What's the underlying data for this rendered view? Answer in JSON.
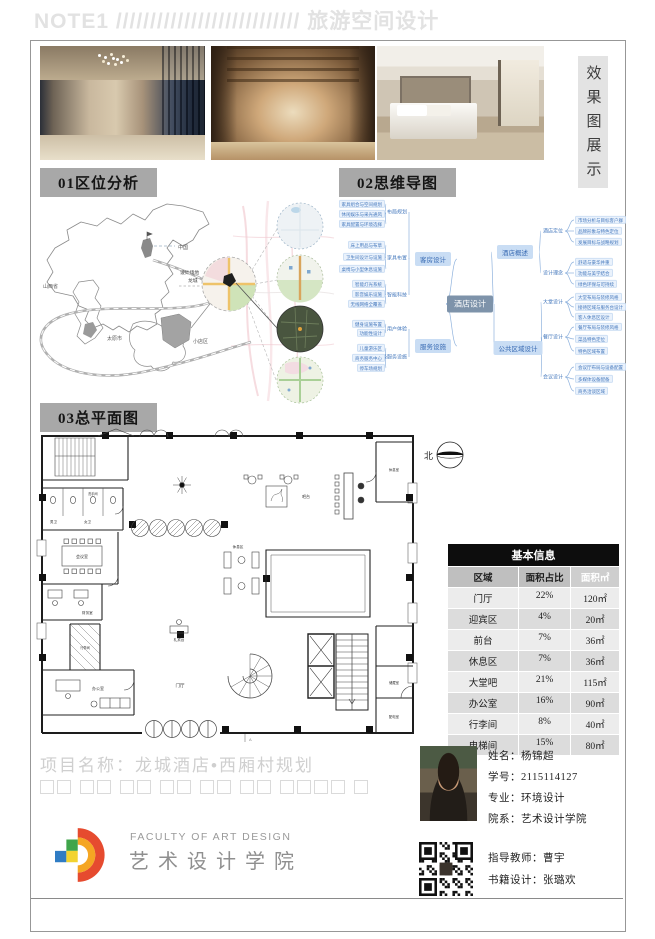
{
  "header": {
    "title": "NOTE1 /////////////////////////// 旅游空间设计"
  },
  "gallery": {
    "label": "效果图展示"
  },
  "sections": {
    "s1": "01区位分析",
    "s2": "02思维导图",
    "s3": "03总平面图"
  },
  "map": {
    "country": "中国",
    "province": "山西省",
    "city": "太原市",
    "district": "小店区",
    "site_line1": "设计场地",
    "site_line2": "龙城"
  },
  "mindmap": {
    "center": "酒店设计",
    "branches": [
      {
        "label": "客房设计",
        "children": [
          {
            "label": "布局规划",
            "leaves": [
              "家具组合与空间规划",
              "休闲娱乐与采光通风",
              "家具配置与环境选择"
            ]
          },
          {
            "label": "家具布置",
            "leaves": [
              "床上用品与布草",
              "卫生间设计与设施",
              "桌椅与小型休息设施"
            ]
          },
          {
            "label": "智能科技",
            "leaves": [
              "智能灯光系统",
              "影音娱乐设施",
              "无线网络全覆盖"
            ]
          }
        ]
      },
      {
        "label": "服务设施",
        "children": [
          {
            "label": "用户体验",
            "leaves": [
              "健身设施布置",
              "功能性设计"
            ]
          },
          {
            "label": "高级服务设施",
            "leaves": [
              "儿童游乐区",
              "商务服务中心",
              "停车场规划"
            ]
          }
        ]
      },
      {
        "label": "酒店概述",
        "children": [
          {
            "label": "酒店定位",
            "leaves": [
              "市场分析与目标客户群",
              "品牌形象与特色定位",
              "发展目标与战略规划"
            ]
          },
          {
            "label": "设计理念",
            "leaves": [
              "舒适与豪华并重",
              "功能与美学结合",
              "绿色环保与可持续"
            ]
          }
        ]
      },
      {
        "label": "公共区域设计",
        "children": [
          {
            "label": "大堂设计",
            "leaves": [
              "大堂布局与装修风格",
              "接待区域与服务台设计",
              "客人休息区设计"
            ]
          },
          {
            "label": "餐厅设计",
            "leaves": [
              "餐厅布局与装修风格",
              "菜品特色定位",
              "特色区域布置"
            ]
          },
          {
            "label": "会议设计",
            "leaves": [
              "会议厅布局与设备配置",
              "多媒体设备配备",
              "商务洽谈区域"
            ]
          }
        ]
      }
    ]
  },
  "floorplan": {
    "north": "北",
    "section_mark": "A",
    "rooms": {
      "wc": "洗手间",
      "men": "男卫",
      "women": "女卫",
      "meeting": "会议室",
      "finance": "财务室",
      "luggage": "行李间",
      "office": "办公室",
      "bar": "吧台",
      "lounge": "休息区",
      "concierge": "礼宾台",
      "lobby": "门厅",
      "rest": "休息室",
      "storage": "储藏室",
      "power": "配电室"
    }
  },
  "table": {
    "title": "基本信息",
    "columns": [
      "区域",
      "面积占比",
      "面积㎡"
    ],
    "rows": [
      [
        "门厅",
        "22%",
        "120㎡"
      ],
      [
        "迎宾区",
        "4%",
        "20㎡"
      ],
      [
        "前台",
        "7%",
        "36㎡"
      ],
      [
        "休息区",
        "7%",
        "36㎡"
      ],
      [
        "大堂吧",
        "21%",
        "115㎡"
      ],
      [
        "办公室",
        "16%",
        "90㎡"
      ],
      [
        "行李间",
        "8%",
        "40㎡"
      ],
      [
        "电梯间",
        "15%",
        "80㎡"
      ]
    ]
  },
  "footer": {
    "project": "项目名称：龙城酒店•西厢村规划",
    "box_groups": [
      2,
      2,
      2,
      2,
      2,
      2,
      4,
      1
    ],
    "logo_en": "FACULTY OF ART DESIGN",
    "logo_cn": "艺术设计学院"
  },
  "student": {
    "fields": [
      {
        "label": "姓名：",
        "value": "杨锦超"
      },
      {
        "label": "学号：",
        "value": "2115114127"
      },
      {
        "label": "专业：",
        "value": "环境设计"
      },
      {
        "label": "院系：",
        "value": "艺术设计学院"
      }
    ],
    "credits": [
      {
        "label": "指导教师：",
        "value": "曹宇"
      },
      {
        "label": "书籍设计：",
        "value": "张璐欢"
      }
    ]
  },
  "colors": {
    "section_bg": "#a8a8a8",
    "mindmap_blue": "#4679bd",
    "table_header": "#0d0d0d",
    "frame": "#979797"
  }
}
